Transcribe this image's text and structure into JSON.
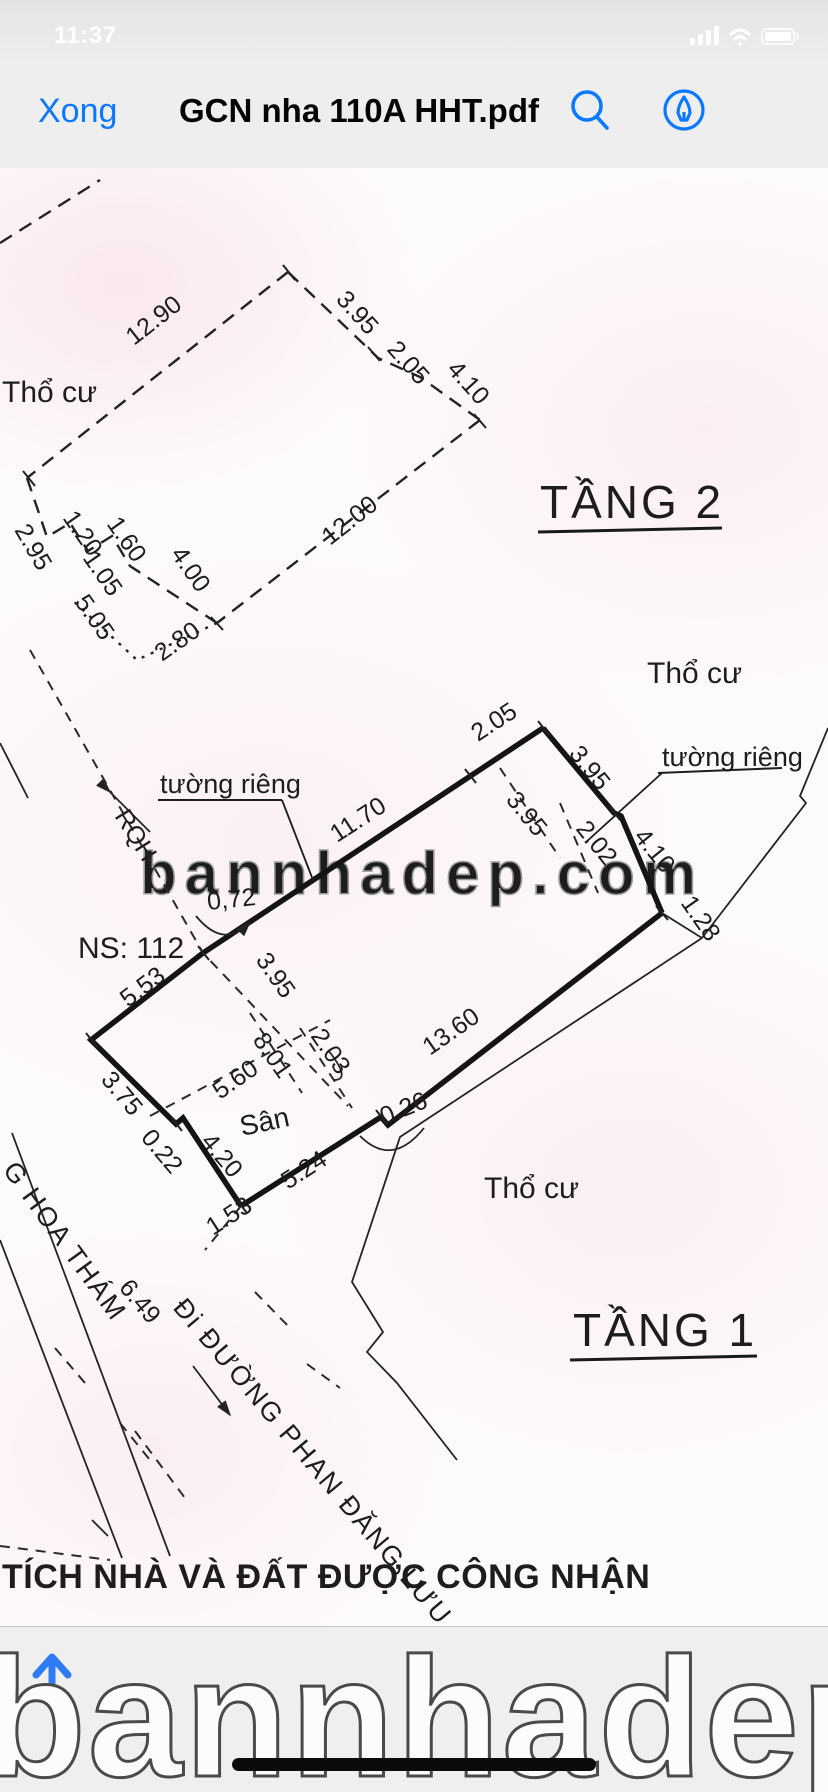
{
  "status_bar": {
    "time": "11:37"
  },
  "nav_bar": {
    "done": "Xong",
    "title": "GCN nha 110A HHT.pdf"
  },
  "colors": {
    "accent_blue": "#0b79ff",
    "line": "#1d1d1d",
    "page_tint": "#fdfafb",
    "footer_bg": "#efefef"
  },
  "plan": {
    "watermark": "bannhadep.com",
    "floor2": {
      "title": "TẦNG 2",
      "area_label": "Thổ cư",
      "dims": {
        "d1290": "12.90",
        "d395": "3.95",
        "d205": "2.05",
        "d410": "4.10",
        "d1200": "12.00",
        "d295": "2.95",
        "d120": "1.20",
        "d160": "1.60",
        "d105": "1.05",
        "d400": "4.00",
        "d505": "5.05",
        "d280": "2.80"
      }
    },
    "floor1": {
      "title": "TẦNG 1",
      "area_label_right": "Thổ cư",
      "area_label_bottom": "Thổ cư",
      "wall_label_left": "tường riêng",
      "wall_label_right": "tường riêng",
      "boundary_label": "RQH",
      "house_number": "NS: 112",
      "yard_label": "Sân",
      "dims": {
        "d072": "0,72",
        "d1170": "11.70",
        "d205": "2.05",
        "d395_out": "3.95",
        "d395_in": "3.95",
        "d202": "2.02",
        "d410": "4.10",
        "d128": "1.28",
        "d553": "5.53",
        "d375": "3.75",
        "d022": "0.22",
        "d420": "4.20",
        "d524": "5.24",
        "d026": "0.26",
        "d1360": "13.60",
        "d153": "1.53",
        "d649": "6.49",
        "d395_mid": "3.95",
        "d203_mid": "2.03",
        "d801": "8.01",
        "d560": "5.60"
      }
    },
    "streets": {
      "hoa_tham": "G HOA THÁM",
      "phan_dang_luu": "Đi ĐƯỜNG PHAN ĐĂNG LƯU"
    },
    "caption": "TÍCH NHÀ VÀ ĐẤT ĐƯỢC CÔNG NHẬN"
  },
  "footer": {
    "watermark": "bannhadep.com"
  }
}
